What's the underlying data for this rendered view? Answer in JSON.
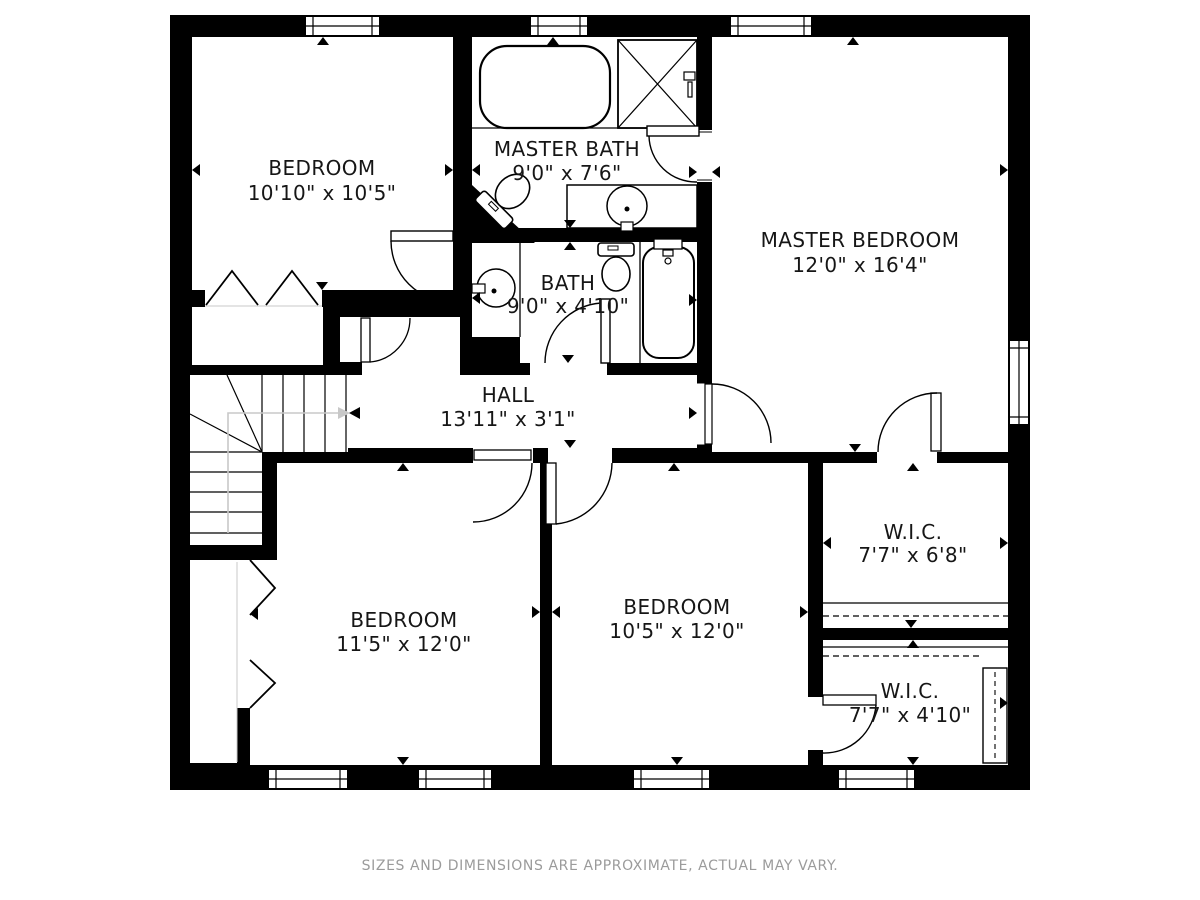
{
  "plan": {
    "title": "second-floor-plan",
    "footer": "SIZES AND DIMENSIONS ARE APPROXIMATE, ACTUAL MAY VARY.",
    "rooms": [
      {
        "name": "BEDROOM",
        "dims": "10'10\" x 10'5\""
      },
      {
        "name": "MASTER BATH",
        "dims": "9'0\" x 7'6\""
      },
      {
        "name": "MASTER BEDROOM",
        "dims": "12'0\" x 16'4\""
      },
      {
        "name": "BATH",
        "dims": "9'0\" x 4'10\""
      },
      {
        "name": "HALL",
        "dims": "13'11\" x 3'1\""
      },
      {
        "name": "BEDROOM",
        "dims": "11'5\" x 12'0\""
      },
      {
        "name": "BEDROOM",
        "dims": "10'5\" x 12'0\""
      },
      {
        "name": "W.I.C.",
        "dims": "7'7\" x 6'8\""
      },
      {
        "name": "W.I.C.",
        "dims": "7'7\" x 4'10\""
      }
    ],
    "colors": {
      "wall": "#000000",
      "floor": "#ffffff",
      "label_text": "#161616",
      "footer_text": "#9b9b9b",
      "stair_guide": "#c8c8c8"
    }
  }
}
